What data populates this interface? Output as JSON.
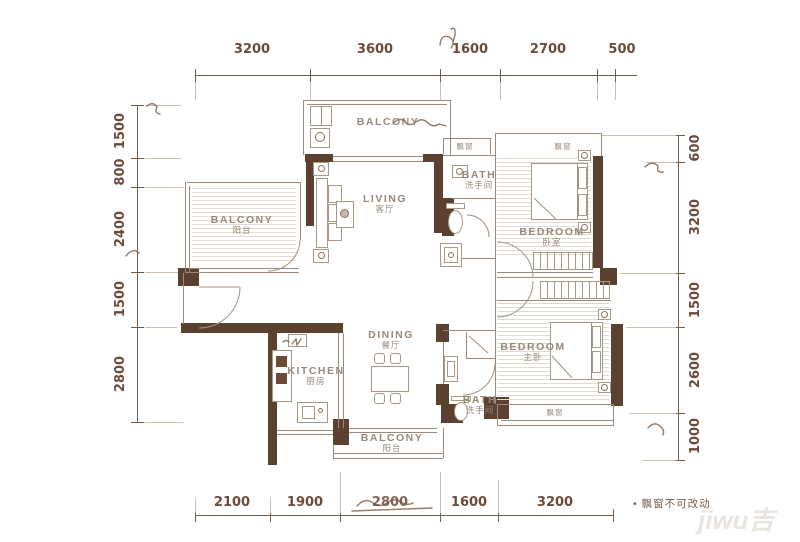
{
  "dims": {
    "top": [
      "3200",
      "3600",
      "1600",
      "2700",
      "500"
    ],
    "bottom": [
      "2100",
      "1900",
      "2800",
      "1600",
      "3200"
    ],
    "left": [
      "1500",
      "800",
      "2400",
      "1500",
      "2800"
    ],
    "right": [
      "600",
      "3200",
      "1500",
      "2600",
      "1000"
    ]
  },
  "rooms": {
    "balcony_top": {
      "en": "BALCONY"
    },
    "balcony_left": {
      "en": "BALCONY",
      "zh": "阳台"
    },
    "living": {
      "en": "LIVING",
      "zh": "客厅"
    },
    "dining": {
      "en": "DINING",
      "zh": "餐厅"
    },
    "kitchen": {
      "en": "KITCHEN",
      "zh": "厨房"
    },
    "bath_top": {
      "en": "BATH",
      "zh": "洗手间"
    },
    "bath_bottom": {
      "en": "BATH",
      "zh": "洗手间"
    },
    "bedroom_top": {
      "en": "BEDROOM",
      "zh": "卧室"
    },
    "bedroom_master": {
      "en": "BEDROOM",
      "zh": "主卧"
    },
    "balcony_bottom": {
      "en": "BALCONY",
      "zh": "阳台"
    }
  },
  "labels": {
    "bay": "飘窗",
    "note": "• 飘窗不可改动",
    "watermark": "jiwu吉"
  },
  "colors": {
    "wall": "#5c4030",
    "dimension": "#7a5b46",
    "room_label": "#98887a"
  }
}
